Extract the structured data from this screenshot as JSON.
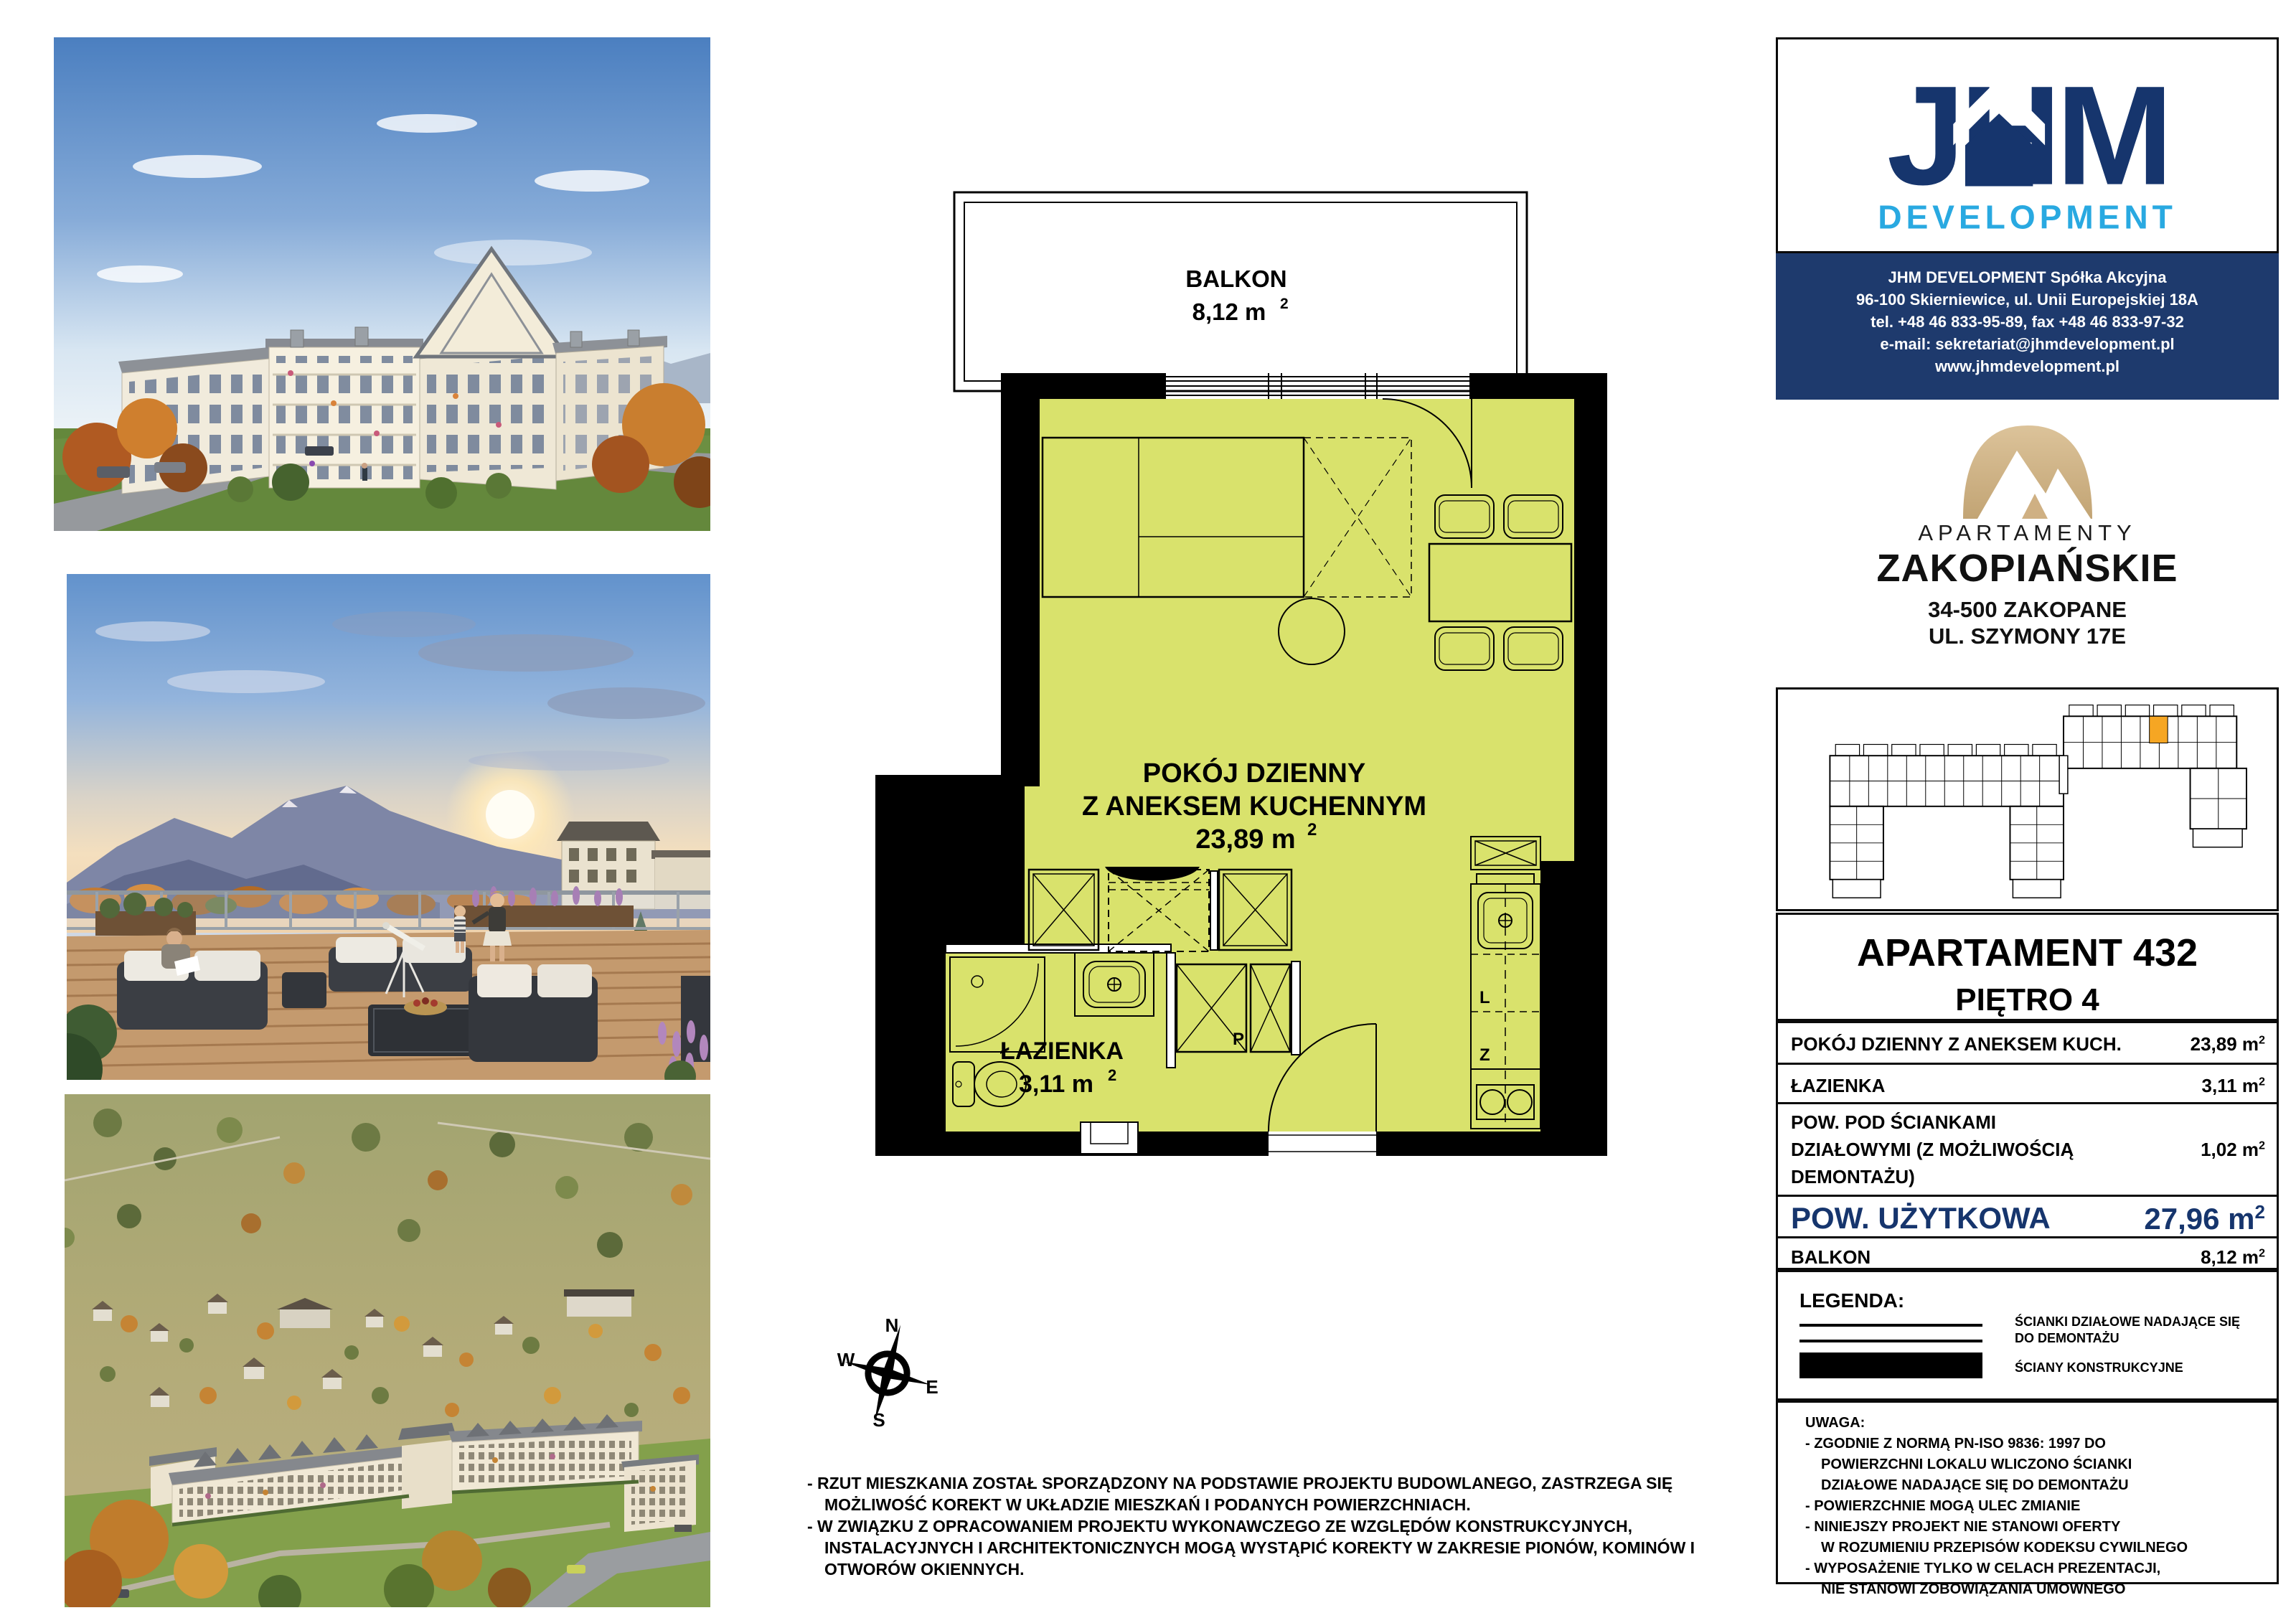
{
  "units": {
    "sup": "2"
  },
  "plan": {
    "balcony_label": "BALKON",
    "balcony_area": "8,12 m",
    "room_line1": "POKÓJ DZIENNY",
    "room_line2": "Z ANEKSEM KUCHENNYM",
    "room_area": "23,89 m",
    "bath_label": "ŁAZIENKA",
    "bath_area": "3,11 m",
    "washer": "P",
    "fridge": "L",
    "dishwasher": "Z"
  },
  "compass": {
    "n": "N",
    "e": "E",
    "s": "S",
    "w": "W"
  },
  "footnotes": [
    "- RZUT MIESZKANIA ZOSTAŁ SPORZĄDZONY NA PODSTAWIE PROJEKTU BUDOWLANEGO, ZASTRZEGA SIĘ",
    "MOŻLIWOŚĆ KOREKT W UKŁADZIE MIESZKAŃ I PODANYCH POWIERZCHNIACH.",
    "- W ZWIĄZKU Z OPRACOWANIEM PROJEKTU WYKONAWCZEGO ZE WZGLĘDÓW KONSTRUKCYJNYCH,",
    "INSTALACYJNYCH I ARCHITEKTONICZNYCH MOGĄ WYSTĄPIĆ KOREKTY W ZAKRESIE PIONÓW, KOMINÓW I",
    "OTWORÓW OKIENNYCH."
  ],
  "developer": {
    "logo_text": "JHM",
    "logo_sub": "DEVELOPMENT",
    "company": "JHM DEVELOPMENT Spółka Akcyjna",
    "address": "96-100 Skierniewice, ul. Unii Europejskiej 18A",
    "phones": "tel. +48 46 833-95-89, fax +48 46 833-97-32",
    "email": "e-mail: sekretariat@jhmdevelopment.pl",
    "website": "www.jhmdevelopment.pl"
  },
  "project": {
    "brand_top": "APARTAMENTY",
    "brand_main": "ZAKOPIAŃSKIE",
    "addr1": "34-500 ZAKOPANE",
    "addr2": "UL. SZYMONY 17E"
  },
  "apartment": {
    "title": "APARTAMENT 432",
    "floor": "PIĘTRO 4"
  },
  "table": {
    "rows": [
      {
        "label": "POKÓJ DZIENNY Z ANEKSEM KUCH.",
        "area": "23,89 m"
      },
      {
        "label": "ŁAZIENKA",
        "area": "3,11 m"
      },
      {
        "l1": "POW. POD ŚCIANKAMI",
        "l2": "DZIAŁOWYMI (Z MOŻLIWOŚCIĄ",
        "l3": "DEMONTAŻU)",
        "area": "1,02 m"
      }
    ],
    "total": {
      "label": "POW. UŻYTKOWA",
      "area": "27,96 m"
    },
    "balkon": {
      "label": "BALKON",
      "area": "8,12 m"
    }
  },
  "legend": {
    "title": "LEGENDA:",
    "item1_l1": "ŚCIANKI DZIAŁOWE NADAJĄCE SIĘ",
    "item1_l2": "DO DEMONTAŻU",
    "item2": "ŚCIANY KONSTRUKCYJNE"
  },
  "uwaga": {
    "title": "UWAGA:",
    "lines": [
      "- ZGODNIE Z NORMĄ PN-ISO 9836: 1997 DO",
      "POWIERZCHNI LOKALU WLICZONO ŚCIANKI",
      "DZIAŁOWE NADAJĄCE SIĘ DO DEMONTAŻU",
      "- POWIERZCHNIE MOGĄ ULEC ZMIANIE",
      "- NINIEJSZY PROJEKT NIE STANOWI OFERTY",
      "W ROZUMIENIU PRZEPISÓW KODEKSU CYWILNEGO",
      "- WYPOSAŻENIE TYLKO W CELACH PREZENTACJI,",
      "NIE STANOWI ZOBOWIĄZANIA UMOWNEGO"
    ]
  },
  "colors": {
    "navy": "#1e3a6d",
    "light_blue": "#29a9e1",
    "gold": "#cdb183",
    "plan_green": "#d9e26c",
    "highlight_orange": "#f6a623"
  }
}
